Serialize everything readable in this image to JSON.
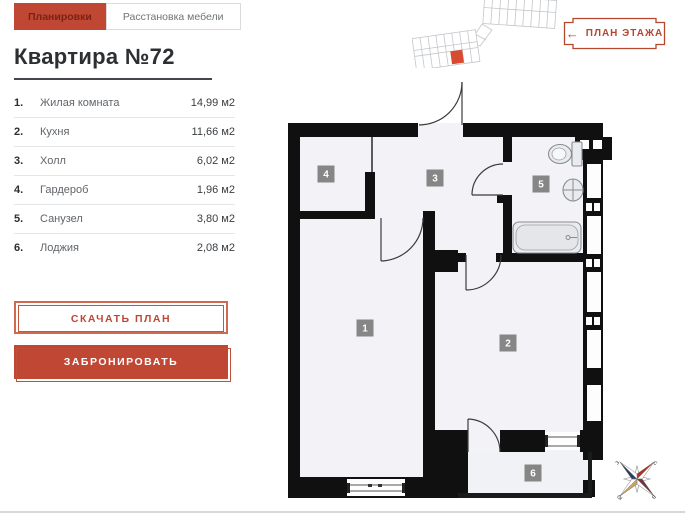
{
  "tabs": [
    {
      "label": "Планировки",
      "active": true
    },
    {
      "label": "Расстановка мебели",
      "active": false
    }
  ],
  "title": "Квартира №72",
  "rooms": [
    {
      "num": "1.",
      "name": "Жилая комната",
      "area": "14,99 м2"
    },
    {
      "num": "2.",
      "name": "Кухня",
      "area": "11,66 м2"
    },
    {
      "num": "3.",
      "name": "Холл",
      "area": "6,02 м2"
    },
    {
      "num": "4.",
      "name": "Гардероб",
      "area": "1,96 м2"
    },
    {
      "num": "5.",
      "name": "Санузел",
      "area": "3,80 м2"
    },
    {
      "num": "6.",
      "name": "Лоджия",
      "area": "2,08 м2"
    }
  ],
  "buttons": {
    "download": "СКАЧАТЬ ПЛАН",
    "book": "ЗАБРОНИРОВАТЬ"
  },
  "floor_plan_button": {
    "arrow": "←",
    "label": "ПЛАН ЭТАЖА"
  },
  "plan_labels": [
    "1",
    "2",
    "3",
    "4",
    "5",
    "6"
  ],
  "compass": {
    "n": "с",
    "e": "в",
    "s": "ю",
    "w": "з"
  },
  "colors": {
    "accent": "#bf4734",
    "accent_text": "#7a2315",
    "wall": "#111111",
    "floor": "#f3f3f7",
    "room_label_bg": "#868686",
    "selected_unit": "#d84b31"
  }
}
